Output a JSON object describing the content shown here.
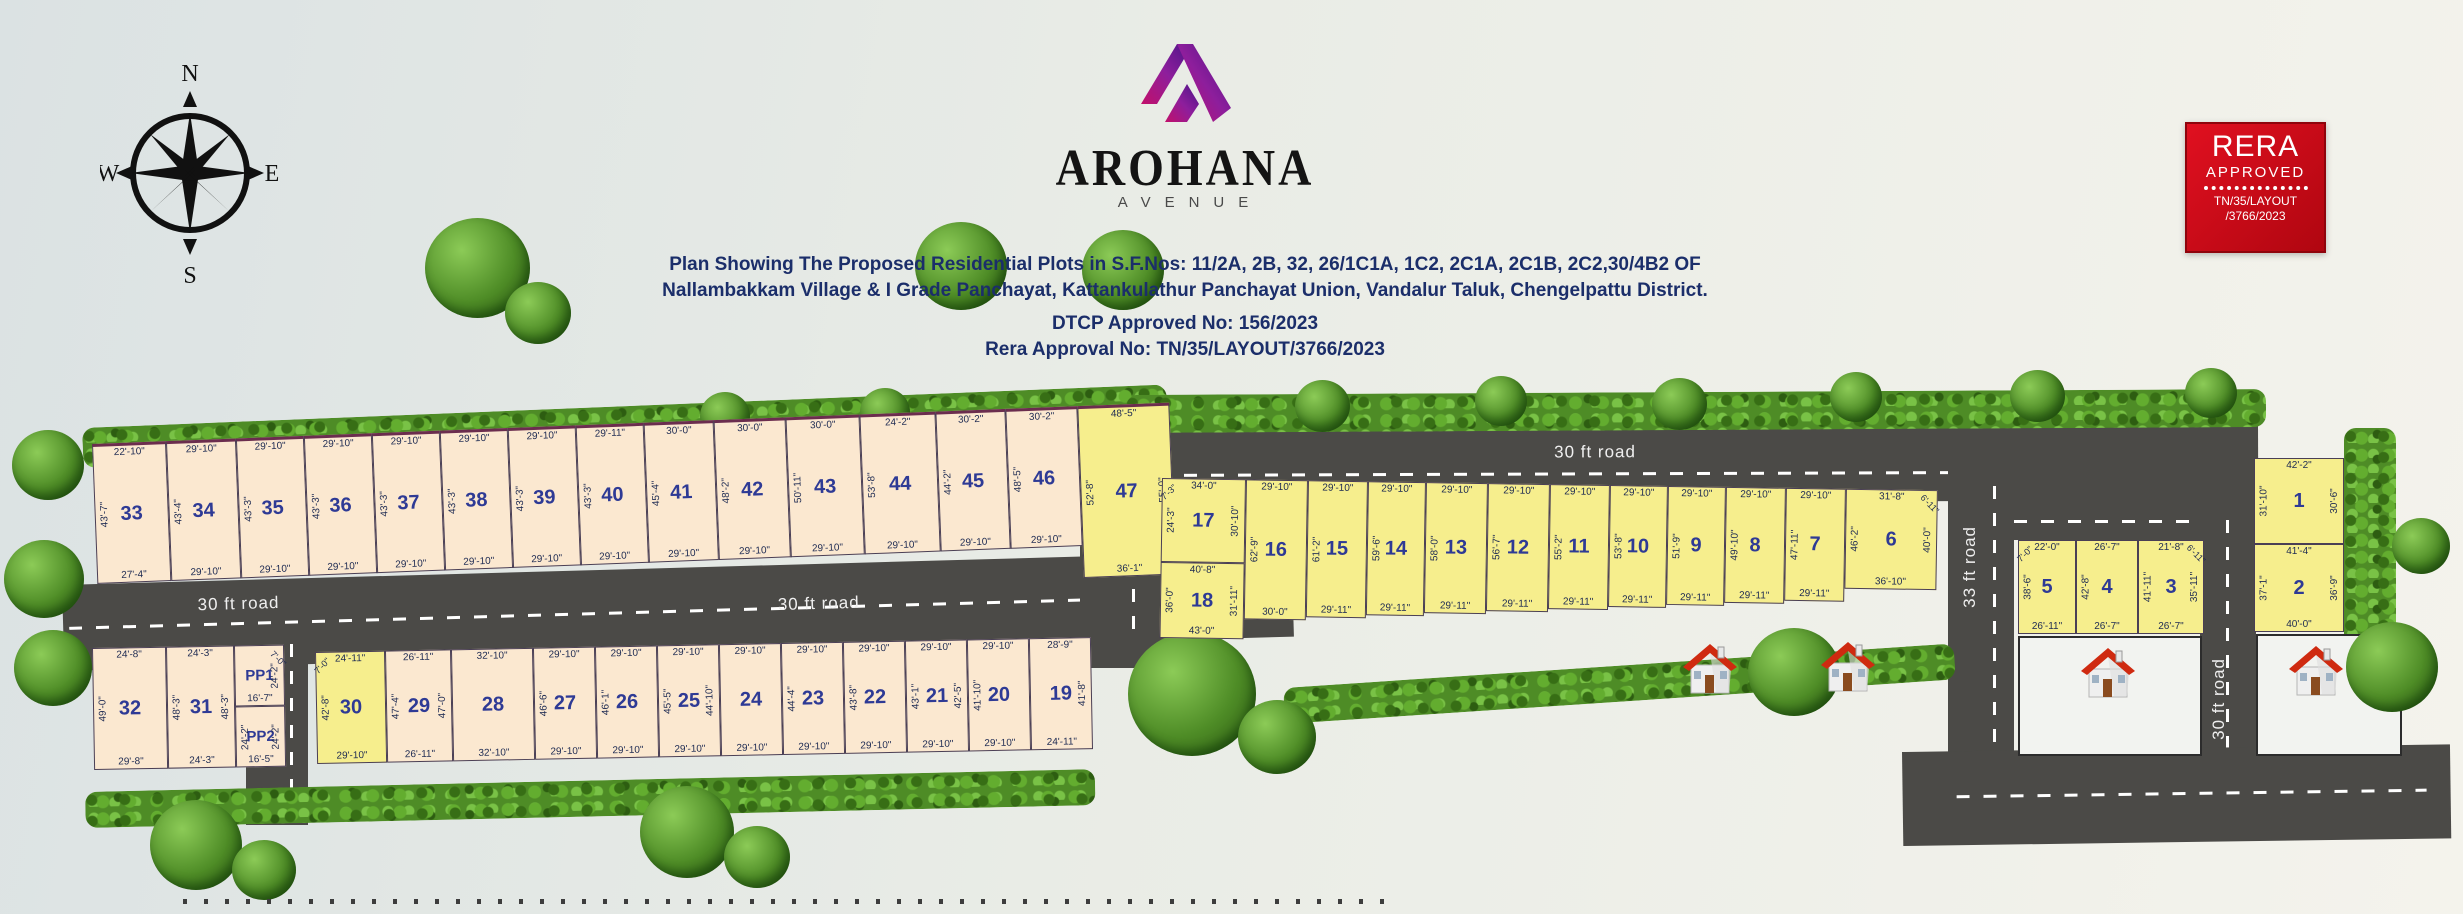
{
  "compass": {
    "n": "N",
    "e": "E",
    "s": "S",
    "w": "W"
  },
  "logo": {
    "name": "AROHANA",
    "sub": "AVENUE"
  },
  "title": {
    "line1": "Plan Showing The Proposed Residential Plots in S.F.Nos: 11/2A, 2B, 32, 26/1C1A, 1C2, 2C1A, 2C1B, 2C2,30/4B2 OF",
    "line2": "Nallambakkam Village & I Grade Panchayat, Kattankulathur Panchayat Union, Vandalur Taluk, Chengelpattu District.",
    "dtcp": "DTCP Approved No: 156/2023",
    "rera": "Rera Approval No: TN/35/LAYOUT/3766/2023"
  },
  "badge": {
    "title": "RERA",
    "subtitle": "APPROVED",
    "ref1": "TN/35/LAYOUT",
    "ref2": "/3766/2023"
  },
  "roads": {
    "left_a": "30 ft road",
    "left_b": "30 ft road",
    "middle": "30 ft road",
    "right_v": "30 ft road",
    "cross_bl": "33 ft road",
    "cross_mid": "33 ft road",
    "cross_right": "33 ft road"
  },
  "colors": {
    "plot_cream": "#fbe8d0",
    "plot_yellow": "#f6ee8d",
    "road": "#4b4a47",
    "accent_navy": "#1b2e6a",
    "badge_red": "#d40f1b"
  },
  "plots": {
    "top_row": [
      {
        "num": "33",
        "top": "22'-10\"",
        "left": "43'-7\"",
        "bottom": "27'-4\""
      },
      {
        "num": "34",
        "top": "29'-10\"",
        "left": "43'-4\"",
        "bottom": "29'-10\""
      },
      {
        "num": "35",
        "top": "29'-10\"",
        "left": "43'-3\"",
        "bottom": "29'-10\""
      },
      {
        "num": "36",
        "top": "29'-10\"",
        "left": "43'-3\"",
        "bottom": "29'-10\""
      },
      {
        "num": "37",
        "top": "29'-10\"",
        "left": "43'-3\"",
        "bottom": "29'-10\""
      },
      {
        "num": "38",
        "top": "29'-10\"",
        "left": "43'-3\"",
        "bottom": "29'-10\""
      },
      {
        "num": "39",
        "top": "29'-10\"",
        "left": "43'-3\"",
        "bottom": "29'-10\""
      },
      {
        "num": "40",
        "top": "29'-11\"",
        "left": "43'-3\"",
        "bottom": "29'-10\""
      },
      {
        "num": "41",
        "top": "30'-0\"",
        "left": "45'-4\"",
        "bottom": "29'-10\""
      },
      {
        "num": "42",
        "top": "30'-0\"",
        "left": "48'-2\"",
        "bottom": "29'-10\""
      },
      {
        "num": "43",
        "top": "30'-0\"",
        "left": "50'-11\"",
        "bottom": "29'-10\""
      },
      {
        "num": "44",
        "top": "24'-2\"",
        "left": "53'-8\"",
        "bottom": "29'-10\""
      },
      {
        "num": "45",
        "top": "30'-2\"",
        "left": "44'-2\"",
        "bottom": "29'-10\""
      },
      {
        "num": "46",
        "top": "30'-2\"",
        "left": "48'-5\"",
        "bottom": "29'-10\""
      },
      {
        "num": "47",
        "top": "48'-5\"",
        "left": "52'-8\"",
        "right": "55'-0\"",
        "bottom": "36'-1\"",
        "corner_br": "7'-6\""
      }
    ],
    "bottom_left_row": [
      {
        "num": "32",
        "top": "24'-8\"",
        "left": "49'-0\"",
        "bottom": "29'-8\""
      },
      {
        "num": "31",
        "top": "24'-3\"",
        "left": "48'-3\"",
        "right": "48'-3\"",
        "bottom": "24'-3\""
      }
    ],
    "pp_col": [
      {
        "num": "PP1",
        "corner_tr": "7'-0\"",
        "right": "24'-2\"",
        "bottom": "16'-7\""
      },
      {
        "num": "PP2",
        "left": "24'-2\"",
        "right": "24'-2\"",
        "bottom": "16'-5\""
      }
    ],
    "bottom_mid_row": [
      {
        "num": "30",
        "corner_tl": "7'-0\"",
        "top": "24'-11\"",
        "left": "42'-8\"",
        "bottom": "29'-10\""
      },
      {
        "num": "29",
        "top": "26'-11\"",
        "left": "47'-4\"",
        "right": "47'-0\"",
        "bottom": "26'-11\""
      },
      {
        "num": "28",
        "top": "32'-10\"",
        "bottom": "32'-10\""
      },
      {
        "num": "27",
        "top": "29'-10\"",
        "left": "46'-6\"",
        "bottom": "29'-10\""
      },
      {
        "num": "26",
        "top": "29'-10\"",
        "left": "46'-1\"",
        "bottom": "29'-10\""
      },
      {
        "num": "25",
        "top": "29'-10\"",
        "left": "45'-5\"",
        "right": "44'-10\"",
        "bottom": "29'-10\""
      },
      {
        "num": "24",
        "top": "29'-10\"",
        "bottom": "29'-10\""
      },
      {
        "num": "23",
        "top": "29'-10\"",
        "left": "44'-4\"",
        "bottom": "29'-10\""
      },
      {
        "num": "22",
        "top": "29'-10\"",
        "left": "43'-8\"",
        "bottom": "29'-10\""
      },
      {
        "num": "21",
        "top": "29'-10\"",
        "left": "43'-1\"",
        "right": "42'-5\"",
        "bottom": "29'-10\""
      },
      {
        "num": "20",
        "top": "29'-10\"",
        "left": "41'-10\"",
        "bottom": "29'-10\""
      },
      {
        "num": "19",
        "top": "28'-9\"",
        "right": "41'-8\"",
        "bottom": "24'-11\""
      }
    ],
    "mid_right_col": [
      {
        "num": "17",
        "corner_tl": "7'-3\"",
        "top": "34'-0\"",
        "left": "24'-3\"",
        "right": "30'-10\""
      },
      {
        "num": "18",
        "top": "40'-8\"",
        "left": "36'-0\"",
        "right": "31'-11\"",
        "bottom": "43'-0\""
      }
    ],
    "mid_right_row": [
      {
        "num": "16",
        "top": "29'-10\"",
        "left": "62'-9\"",
        "bottom": "30'-0\""
      },
      {
        "num": "15",
        "top": "29'-10\"",
        "left": "61'-2\"",
        "bottom": "29'-11\""
      },
      {
        "num": "14",
        "top": "29'-10\"",
        "left": "59'-6\"",
        "bottom": "29'-11\""
      },
      {
        "num": "13",
        "top": "29'-10\"",
        "left": "58'-0\"",
        "bottom": "29'-11\""
      },
      {
        "num": "12",
        "top": "29'-10\"",
        "left": "56'-7\"",
        "bottom": "29'-11\""
      },
      {
        "num": "11",
        "top": "29'-10\"",
        "left": "55'-2\"",
        "bottom": "29'-11\""
      },
      {
        "num": "10",
        "top": "29'-10\"",
        "left": "53'-8\"",
        "bottom": "29'-11\""
      },
      {
        "num": "9",
        "top": "29'-10\"",
        "left": "51'-9\"",
        "bottom": "29'-11\""
      },
      {
        "num": "8",
        "top": "29'-10\"",
        "left": "49'-10\"",
        "bottom": "29'-11\""
      },
      {
        "num": "7",
        "top": "29'-10\"",
        "left": "47'-11\"",
        "bottom": "29'-11\""
      },
      {
        "num": "6",
        "top": "31'-8\"",
        "corner_tr": "6'-11\"",
        "left": "46'-2\"",
        "right": "40'-0\"",
        "bottom": "36'-10\""
      }
    ],
    "right_543_row": [
      {
        "num": "5",
        "corner_tl": "7'-0\"",
        "top": "22'-0\"",
        "left": "38'-6\"",
        "bottom": "26'-11\""
      },
      {
        "num": "4",
        "top": "26'-7\"",
        "left": "42'-8\"",
        "bottom": "26'-7\""
      },
      {
        "num": "3",
        "top": "21'-8\"",
        "corner_tr": "6'-11\"",
        "left": "41'-11\"",
        "right": "35'-11\"",
        "bottom": "26'-7\""
      }
    ],
    "right_12_col": [
      {
        "num": "1",
        "top": "42'-2\"",
        "left": "31'-10\"",
        "right": "30'-6\""
      },
      {
        "num": "2",
        "top": "41'-4\"",
        "left": "37'-1\"",
        "right": "36'-9\"",
        "bottom": "40'-0\""
      }
    ]
  }
}
